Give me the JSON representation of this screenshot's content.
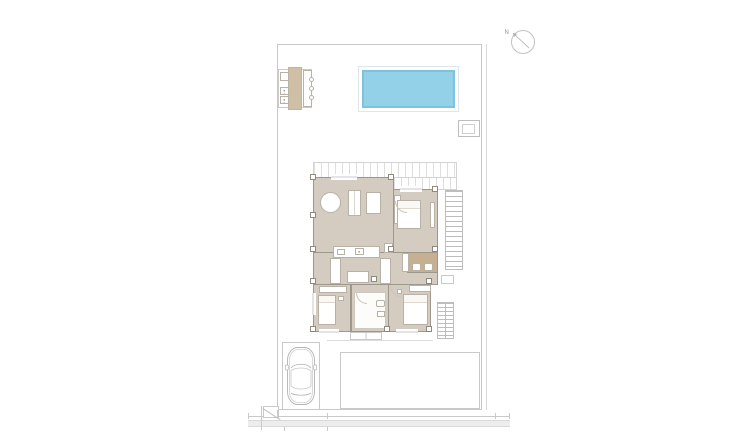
{
  "compass": {
    "north_label": "N"
  },
  "colors": {
    "pool-water": "#92d1e8",
    "pool-edge": "#7fc2dc",
    "pool-frame": "#dce6eb",
    "floor": "#d4ccc0",
    "bath-floor": "#c7b092",
    "kitchen-strip": "#cfc0a5",
    "wall": "#9e978b",
    "pillar": "#8f887c",
    "furniture-outline": "#b8b2a6",
    "outline": "#c9c9c9",
    "slat": "#dedede",
    "street-band": "#ededed",
    "stair": "#bdbdbd",
    "car": "#b3b3b3",
    "label": "#8a8a8a"
  }
}
